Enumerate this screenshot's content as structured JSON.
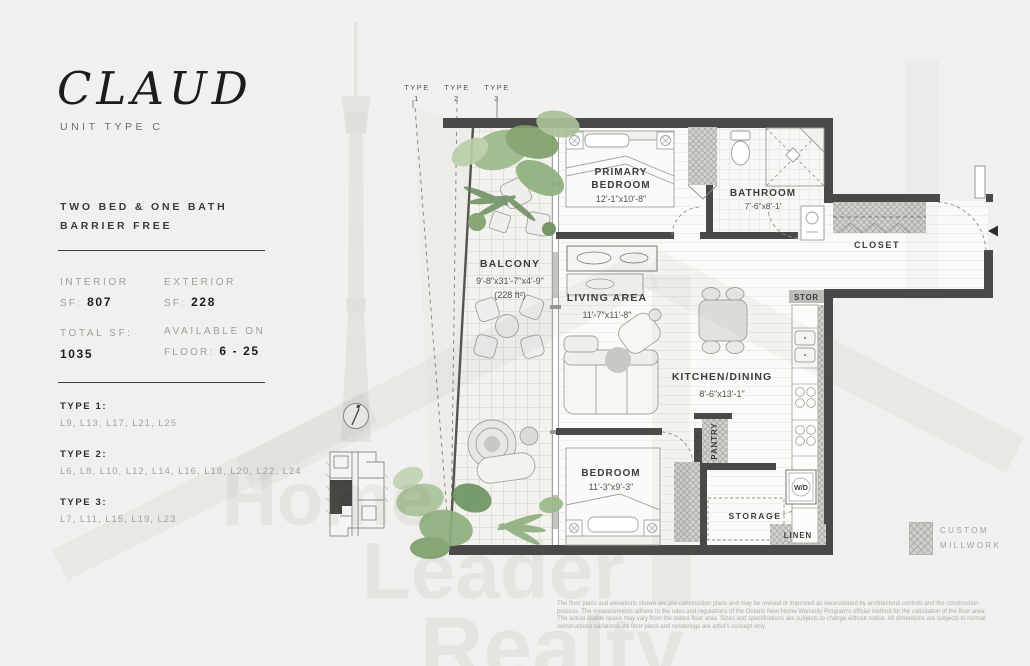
{
  "sidebar": {
    "title": "CLAUD",
    "subtitle": "UNIT TYPE C",
    "description_line1": "TWO BED & ONE BATH",
    "description_line2": "BARRIER FREE",
    "stats": {
      "interior_label": "INTERIOR",
      "interior_prefix": "SF: ",
      "interior_value": "807",
      "exterior_label": "EXTERIOR",
      "exterior_prefix": "SF: ",
      "exterior_value": "228",
      "total_label": "TOTAL SF:",
      "total_value": "1035",
      "available_label": "AVAILABLE ON",
      "available_prefix": "FLOOR: ",
      "available_value": "6 - 25"
    },
    "types": [
      {
        "label": "TYPE 1:",
        "levels": "L9, L13, L17, L21, L25"
      },
      {
        "label": "TYPE 2:",
        "levels": "L6, L8, L10, L12, L14, L16, L18, L20, L22, L24"
      },
      {
        "label": "TYPE 3:",
        "levels": "L7, L11, L15, L19, L23"
      }
    ]
  },
  "plan": {
    "type_markers": [
      {
        "line1": "TYPE",
        "line2": "1"
      },
      {
        "line1": "TYPE",
        "line2": "2"
      },
      {
        "line1": "TYPE",
        "line2": "3"
      }
    ],
    "rooms": {
      "primary_bedroom": {
        "name_line1": "PRIMARY",
        "name_line2": "BEDROOM",
        "dims": "12'-1\"x10'-8\""
      },
      "bathroom": {
        "name": "BATHROOM",
        "dims": "7'-6\"x8'-1'"
      },
      "balcony": {
        "name": "BALCONY",
        "dims": "9'-8\"x31'-7\"x4'-9\"",
        "area": "(228 ft²)"
      },
      "living": {
        "name": "LIVING AREA",
        "dims": "11'-7\"x11'-8\""
      },
      "kitchen": {
        "name": "KITCHEN/DINING",
        "dims": "8'-6\"x13'-1\""
      },
      "bedroom": {
        "name": "BEDROOM",
        "dims": "11'-3\"x9'-3\""
      },
      "closet": "CLOSET",
      "stor": "STOR",
      "pantry": "PANTRY",
      "storage": "STORAGE",
      "linen": "LINEN",
      "wd": "W/D"
    },
    "legend": {
      "line1": "CUSTOM",
      "line2": "MILLWORK"
    }
  },
  "watermark": {
    "word1": "Home",
    "word2": "Leader",
    "word3": "Realty"
  },
  "disclaimer": "The floor plans and elevations shown are pre-construction plans and may be revised or improved as necessitated by architectural controls and the construction process. The measurements adhere to the rules and regulations of the Ontario New Home Warranty Program's official method for the calculation of the floor area. The actual usable space may vary from the stated floor area. Sizes and specifications are subjects to change without notice. All dimentions are subjects to normal constructions variations. All floor plans and renderings are artist's concept only.",
  "colors": {
    "wall": "#4a4947",
    "accent_green": "#86a573",
    "page": "#f1f0ee",
    "watermark": "#a8a49c"
  }
}
